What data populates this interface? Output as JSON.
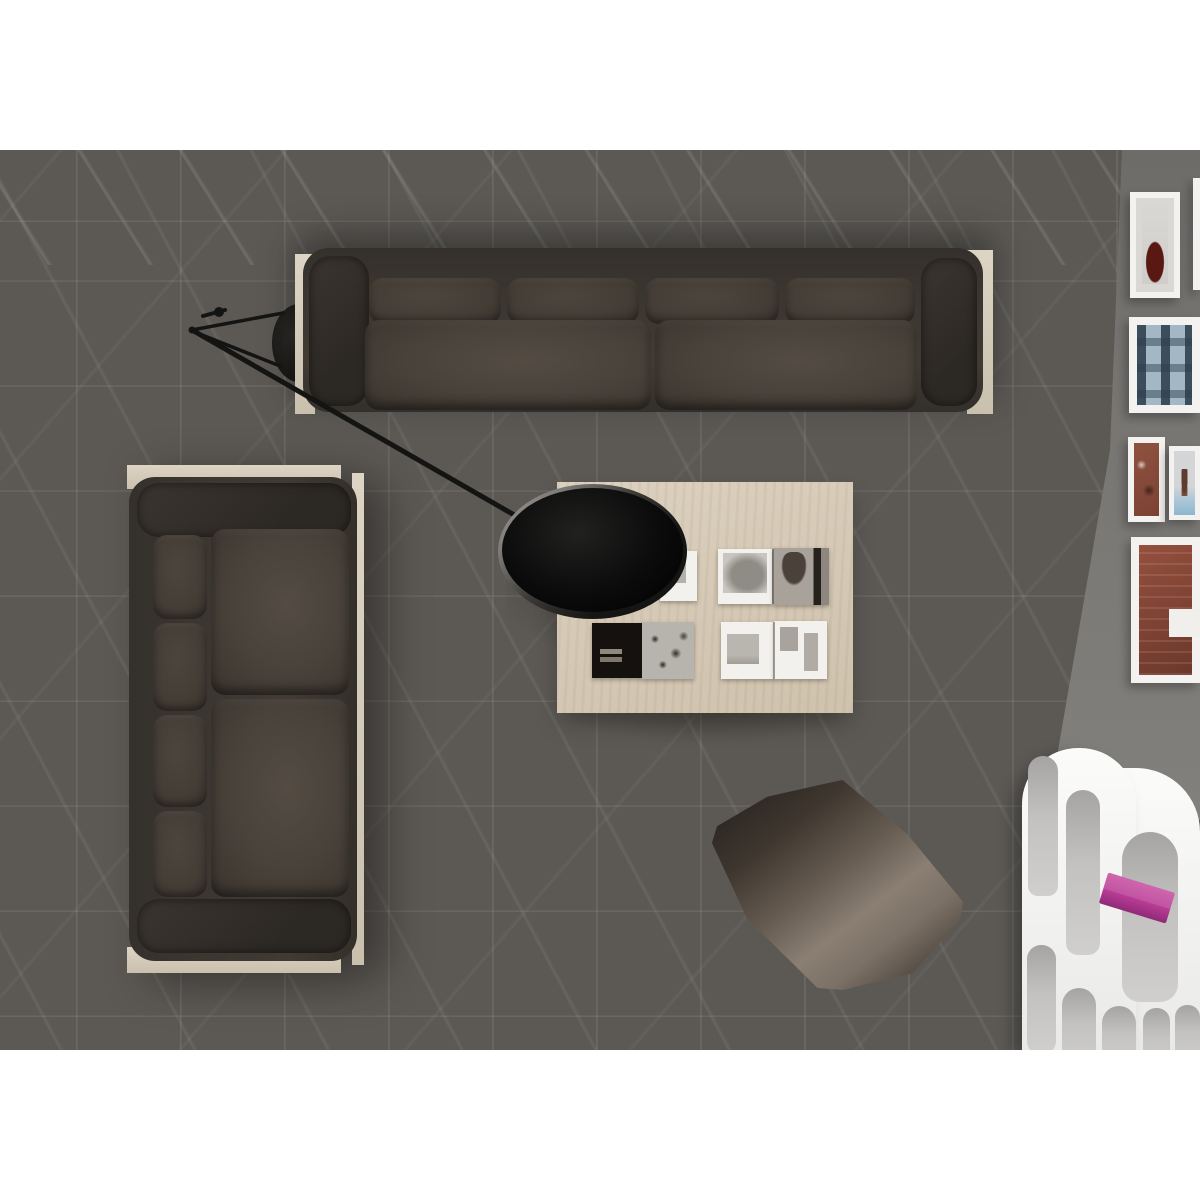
{
  "scene": {
    "type": "photograph",
    "view": "top-down living room",
    "description": "Overhead photo of a living room with dark grey marble tile floor, two dark brown fabric sofas in an L arrangement on light wood bases, a black swing-arm lamp over a light oak coffee table with open black-and-white photo books, a brown floor cushion, a gallery wall of white picture frames on the right, and a white sculptural shelving unit with a magenta shelf",
    "objects": [
      {
        "name": "marble-tile-floor",
        "material": "dark grey marble with white veining"
      },
      {
        "name": "sofa-top",
        "seats": 3,
        "upholstery": "dark brown fabric",
        "frame": "light wood"
      },
      {
        "name": "sofa-left",
        "seats": 2,
        "upholstery": "dark brown fabric",
        "frame": "light wood"
      },
      {
        "name": "swing-arm-lamp",
        "shade": "large black disc",
        "arm": "thin black rod",
        "base": "black disc behind sofa"
      },
      {
        "name": "coffee-table",
        "material": "light oak",
        "items": "four open monochrome photo books"
      },
      {
        "name": "floor-cushion",
        "color": "brown leather-like"
      },
      {
        "name": "gallery-wall",
        "frames": 6,
        "frame_color": "white",
        "art": [
          "dark red object",
          "blue building facade",
          "brick with figures",
          "figure with blue band",
          "large red brick building"
        ]
      },
      {
        "name": "shelf-unit",
        "style": "white organic arched cubbies",
        "accent": "magenta shelf"
      }
    ]
  },
  "colors": {
    "page_bg": "#ffffff",
    "floor_dark": "#393735",
    "floor_mid": "#6b6864",
    "floor_light": "#a6a39e",
    "wall": "#787673",
    "sofa_dark": "#2f2b27",
    "sofa_body": "#3e3832",
    "cushion": "#4a433c",
    "wood_frame": "#d7cdbc",
    "table_wood": "#d6cab7",
    "lamp_black": "#0a0a0a",
    "lamp_rim": "#a3a19d",
    "pouf_light": "#8b7f74",
    "shelf_white": "#f4f4f3",
    "shelf_cell": "#c3c2c0",
    "accent_pink": "#b93d96",
    "frame_white": "#f3f2f0",
    "art_red": "#5a1812",
    "art_blue": "#a3b8c4",
    "art_brick": "#8a4a39",
    "art_sky": "#a9c6d8"
  }
}
